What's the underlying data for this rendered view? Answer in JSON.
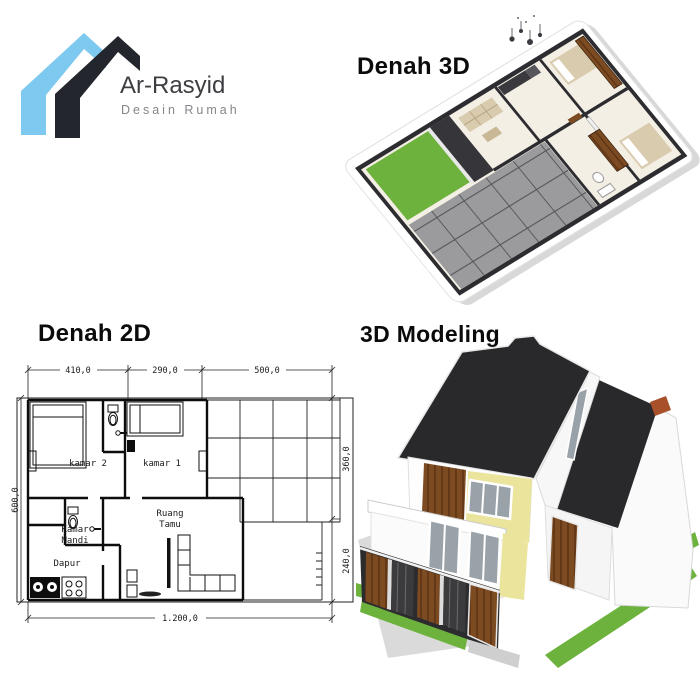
{
  "logo": {
    "title": "Ar-Rasyid",
    "subtitle": "Desain Rumah"
  },
  "sections": {
    "denah3d_label": "Denah 3D",
    "denah2d_label": "Denah 2D",
    "modeling_label": "3D Modeling"
  },
  "floorplan2d": {
    "dimensions": {
      "top": [
        "410,0",
        "290,0",
        "500,0"
      ],
      "left": "600,0",
      "right": [
        "360,0",
        "240,0"
      ],
      "bottom": "1.200,0"
    },
    "rooms": {
      "kamar2": "kamar 2",
      "kamar1": "kamar 1",
      "ruang_tamu_line1": "Ruang",
      "ruang_tamu_line2": "Tamu",
      "kamar_mandi_line1": "Kamar",
      "kamar_mandi_line2": "Mandi",
      "dapur": "Dapur"
    }
  },
  "colors": {
    "logo_blue": "#7ec9ef",
    "logo_dark": "#23262c",
    "brand_text": "#3d3e42",
    "brand_subtext": "#85868a",
    "grass_green": "#6db23d",
    "tile_gray": "#9b9b9d",
    "roof_dark": "#29292b",
    "wall_yellow": "#ebe49c",
    "wood_brown": "#7c4b22",
    "wall_dark": "#2d2d31",
    "floor_cream": "#f4efe4",
    "furniture_tan": "#d9cbae"
  }
}
